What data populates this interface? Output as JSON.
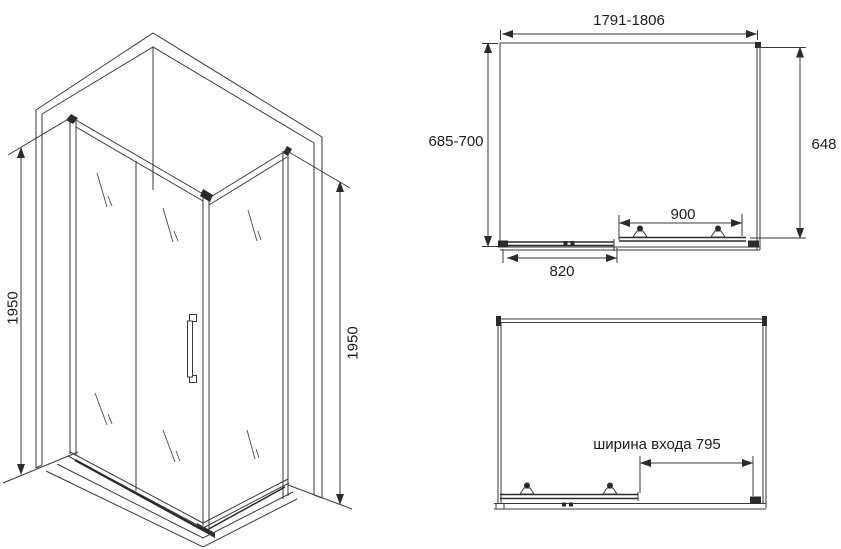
{
  "drawing": {
    "subject": "corner shower enclosure with sliding door - dimensional technical drawing",
    "colors": {
      "line": "#3a3a3a",
      "bold_line": "#2b2b2b",
      "text": "#1c1c1c",
      "background": "#ffffff"
    },
    "isometric_view": {
      "height_left": "1950",
      "height_right": "1950"
    },
    "plan_view": {
      "overall_width": "1791-1806",
      "depth": "685-700",
      "side_panel": "648",
      "door_width": "900",
      "fixed_panel_width": "820"
    },
    "front_plan_view": {
      "entry_width": "ширина входа 795"
    }
  }
}
